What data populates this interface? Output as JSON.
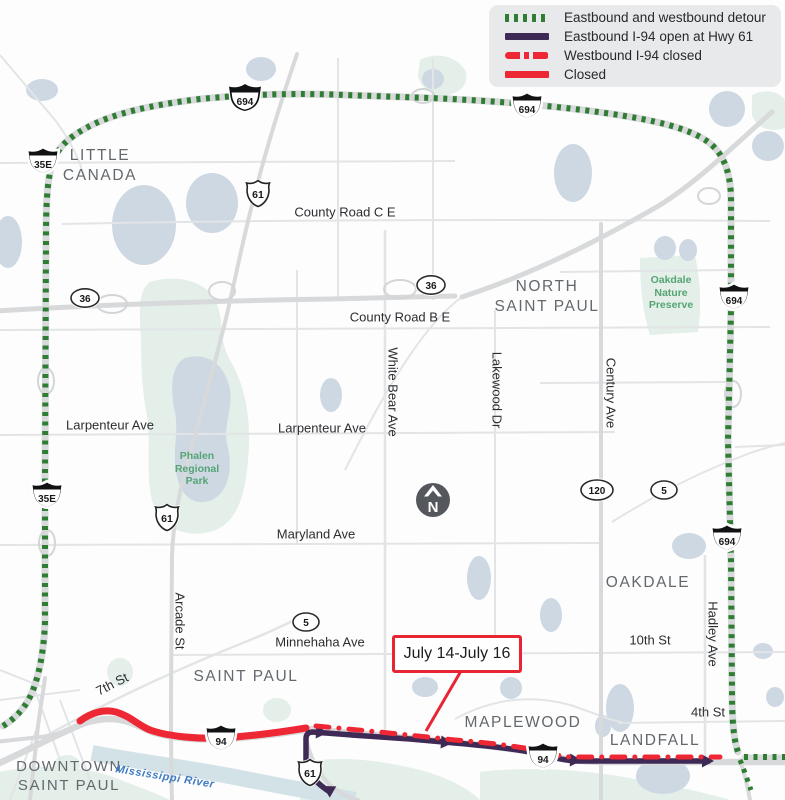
{
  "colors": {
    "detour": "#2e7d33",
    "eb_open": "#3e2a55",
    "closed": "#ee2734",
    "road": "#e2e4e6",
    "road_major": "#d7d9db",
    "water": "#cdd8e3",
    "river": "#d3e2e6",
    "park": "#e3efe8",
    "city_label": "#63686d",
    "street_label": "#2b2d30",
    "park_label": "#55a474",
    "river_label": "#3d7bc2",
    "north_badge": "#54575c",
    "legend_bg": "#e8e9ea",
    "callout_border": "#e82633"
  },
  "legend": {
    "items": [
      {
        "label": "Eastbound and westbound detour",
        "style": "green-dotted"
      },
      {
        "label": "Eastbound I-94 open at Hwy 61",
        "style": "purple-solid"
      },
      {
        "label": "Westbound I-94 closed",
        "style": "red-dash-dot"
      },
      {
        "label": "Closed",
        "style": "red-solid"
      }
    ]
  },
  "callout": {
    "label": "July 14-July 16"
  },
  "north": {
    "label": "N"
  },
  "map": {
    "cities": [
      {
        "lines": [
          "LITTLE",
          "CANADA"
        ]
      },
      {
        "lines": [
          "NORTH",
          "SAINT PAUL"
        ]
      },
      {
        "lines": [
          "OAKDALE"
        ]
      },
      {
        "lines": [
          "SAINT PAUL"
        ]
      },
      {
        "lines": [
          "MAPLEWOOD"
        ]
      },
      {
        "lines": [
          "LANDFALL"
        ]
      },
      {
        "lines": [
          "DOWNTOWN",
          "SAINT PAUL"
        ]
      }
    ],
    "streets": [
      {
        "name": "County Road C E"
      },
      {
        "name": "County Road B E"
      },
      {
        "name": "Larpenteur Ave"
      },
      {
        "name": "Larpenteur Ave"
      },
      {
        "name": "Maryland Ave"
      },
      {
        "name": "Minnehaha Ave"
      },
      {
        "name": "White Bear Ave"
      },
      {
        "name": "Lakewood Dr"
      },
      {
        "name": "Century Ave"
      },
      {
        "name": "Arcade St"
      },
      {
        "name": "Hadley Ave"
      },
      {
        "name": "10th St"
      },
      {
        "name": "4th St"
      },
      {
        "name": "7th St"
      }
    ],
    "parks": [
      {
        "lines": [
          "Phalen",
          "Regional",
          "Park"
        ]
      },
      {
        "lines": [
          "Oakdale",
          "Nature",
          "Preserve"
        ]
      }
    ],
    "river_label": "Mississippi River",
    "shields": [
      {
        "num": "694"
      },
      {
        "num": "694"
      },
      {
        "num": "35E"
      },
      {
        "num": "61"
      },
      {
        "num": "36"
      },
      {
        "num": "36"
      },
      {
        "num": "694"
      },
      {
        "num": "35E"
      },
      {
        "num": "61"
      },
      {
        "num": "120"
      },
      {
        "num": "5"
      },
      {
        "num": "694"
      },
      {
        "num": "5"
      },
      {
        "num": "94"
      },
      {
        "num": "94"
      },
      {
        "num": "61"
      }
    ]
  }
}
